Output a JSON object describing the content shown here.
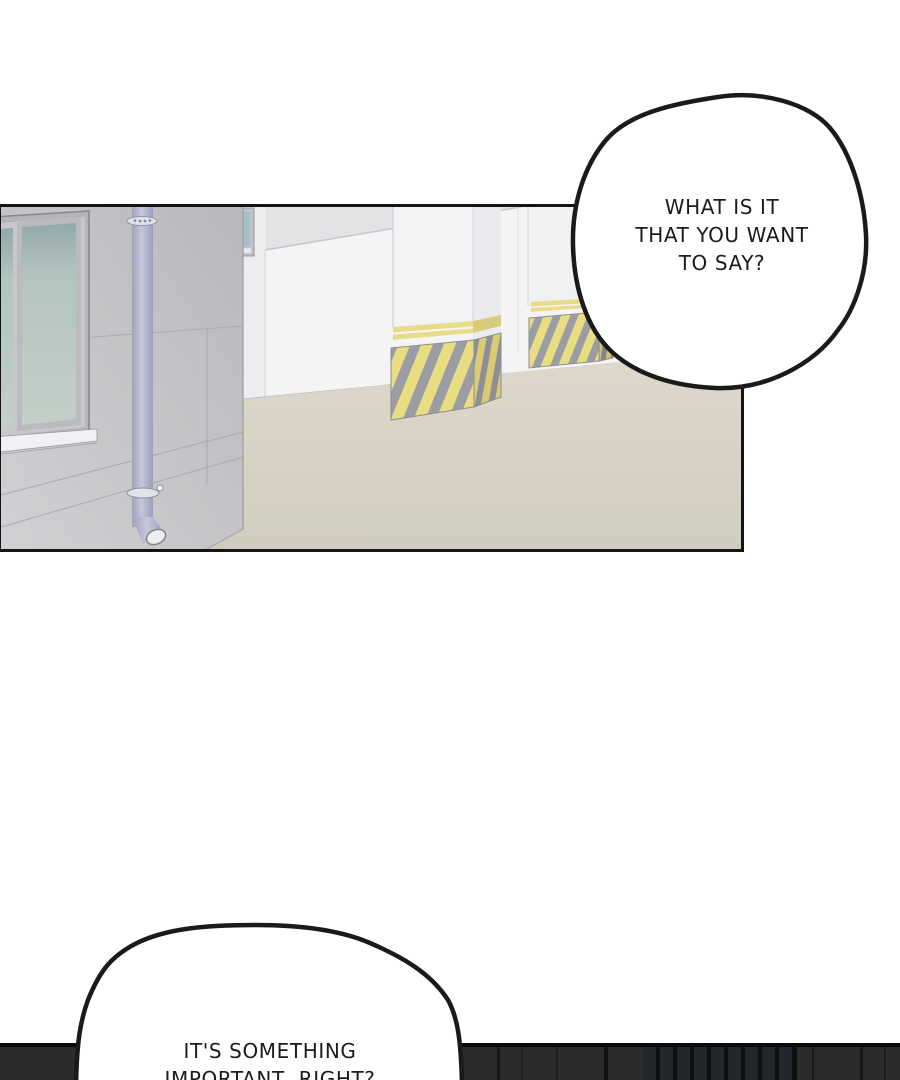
{
  "page": {
    "kind": "comic-page",
    "panel_count": 2
  },
  "bubbles": {
    "top": {
      "lines": [
        "WHAT IS IT",
        "THAT YOU WANT",
        "TO SAY?"
      ]
    },
    "bottom": {
      "lines": [
        "IT'S SOMETHING",
        "IMPORTANT, RIGHT?"
      ]
    }
  },
  "palette": {
    "outline_black": "#141414",
    "hazard_yellow": "#e9dd82",
    "hazard_gray": "#9c9ca4",
    "floor_beige": "#d6d2c4",
    "wall_gray": "#c6c6c9",
    "pipe_lavender": "#b4b6cf",
    "window_glass_green": "#b3c4be",
    "strip_dark": "#2b2b2c"
  }
}
